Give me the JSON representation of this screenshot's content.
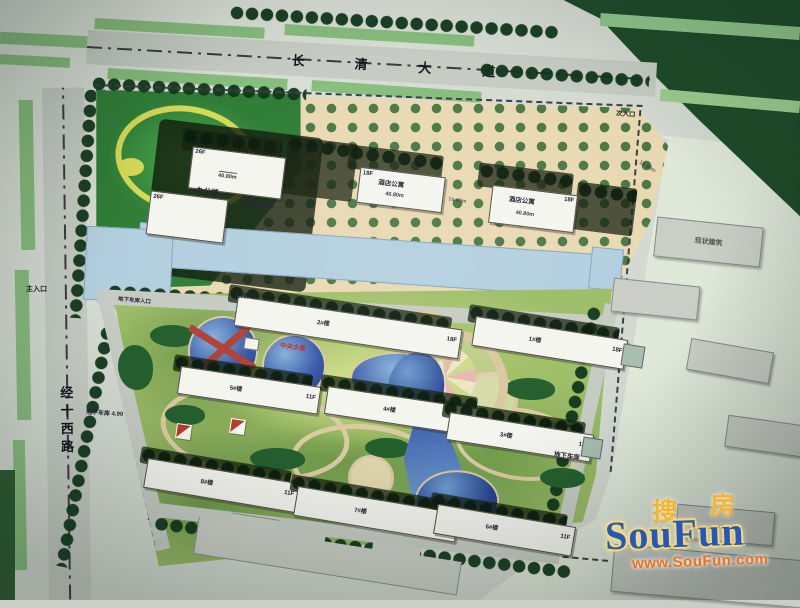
{
  "roads": {
    "north_chars": [
      "长",
      "清",
      "大",
      "道"
    ],
    "west": "经十西路"
  },
  "entrances": {
    "main": "主入口",
    "pedestrian": "人行入口",
    "secondary": "次入口",
    "garage": "地下车库入口"
  },
  "commercial": {
    "office_label": "办公楼",
    "supermarket_label": "底层超市",
    "tower_a_floors": "26F",
    "tower_a_dim": "40.80m",
    "tower_b_floors": "26F",
    "hotel_label": "酒店公寓",
    "hotel_a_floors": "18F",
    "hotel_a_dim": "40.80m",
    "hotel_b_floors": "18F",
    "hotel_b_dim": "40.80m",
    "dim_mid": "74.40m",
    "dim_right": "19.80m"
  },
  "residential": {
    "b1": {
      "name": "1#楼",
      "floors": "18F"
    },
    "b2": {
      "name": "2#楼",
      "floors": "18F"
    },
    "b3": {
      "name": "3#楼",
      "floors": "11F"
    },
    "b4": {
      "name": "4#楼",
      "floors": "11F"
    },
    "b5": {
      "name": "5#楼",
      "floors": "11F"
    },
    "b6": {
      "name": "6#楼",
      "floors": "11F"
    },
    "b7": {
      "name": "7#楼",
      "floors": "11F"
    },
    "b8": {
      "name": "8#楼",
      "floors": "11F"
    }
  },
  "labels": {
    "existing_building": "现状建筑",
    "garage_left": "地下车库 4.90",
    "garage_right": "地下车库",
    "water_feature": "中央水景"
  },
  "watermark": {
    "brand_cn_1": "搜",
    "brand_cn_2": "房",
    "brand_en": "SouFun",
    "url": "www.SouFun.com"
  },
  "colors": {
    "paper": "#d5dbd3",
    "road_gray": "#c6ccc4",
    "lawn_green": "#9dbd68",
    "tree_dark": "#1d4a28",
    "canal_blue": "#b3cfdf",
    "pond_blue": "#2c4b9e",
    "paving_beige": "#e9d9b2",
    "building_white": "#f5f5f0",
    "existing_gray": "#cacec7",
    "accent_red": "#c03028",
    "watermark_blue": "#2158c8",
    "watermark_orange": "#f07018",
    "watermark_yellow": "#f3b62c"
  }
}
